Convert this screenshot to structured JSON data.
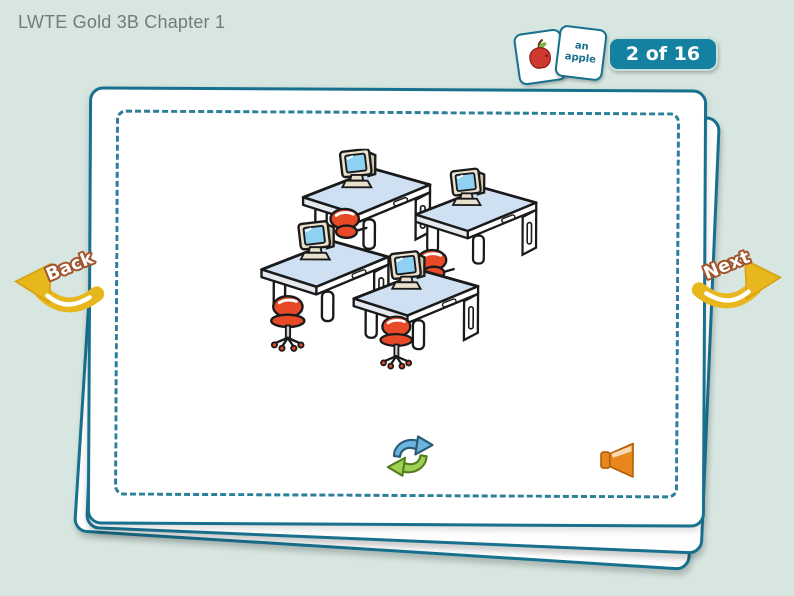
{
  "header": {
    "title": "LWTE Gold 3B Chapter 1",
    "counter": "2 of 16",
    "preview_card": {
      "line1": "an",
      "line2": "apple"
    }
  },
  "navigation": {
    "back_label": "Back",
    "next_label": "Next"
  },
  "card": {
    "illustration_alt": "four school computer desks with beige monitors and red swivel chairs",
    "replay_icon": "circular-replay-arrows",
    "audio_icon": "orange-speaker"
  },
  "colors": {
    "background": "#d7e6e0",
    "card_border_teal": "#17718e",
    "badge_teal": "#1581a2",
    "arrow_gold": "#e7b71d",
    "label_outline_brown": "#a2542c",
    "chair_red": "#e84a28",
    "desk_blue": "#cfe0f2",
    "screen_blue": "#8ed1f2",
    "monitor_beige": "#e9e1cd",
    "apple_red": "#cf3a30",
    "refresh_blue": "#6cb3e0",
    "refresh_green": "#9ed054",
    "speaker_orange": "#e8871c",
    "title_gray": "#6e7e7e"
  }
}
